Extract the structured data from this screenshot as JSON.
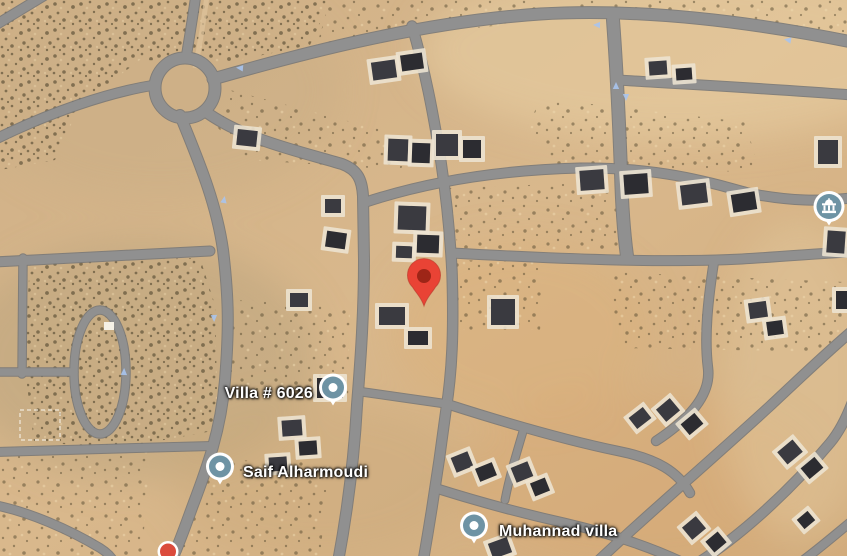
{
  "map": {
    "view_type": "satellite",
    "markers": [
      {
        "id": "destination-pin",
        "kind": "pin",
        "x": 424,
        "y": 313,
        "color": "#E94335",
        "inner_color": "#9E2517"
      },
      {
        "id": "poi-villa-6026",
        "kind": "poi",
        "x": 333,
        "y": 393,
        "color": "#6E93A4",
        "label": "Villa # 6026",
        "label_x": 313,
        "label_y": 394,
        "label_anchor": "end"
      },
      {
        "id": "poi-saif-alharmoudi",
        "kind": "poi",
        "x": 220,
        "y": 472,
        "color": "#6E93A4",
        "label": "Saif Alharmoudi",
        "label_x": 243,
        "label_y": 473,
        "label_anchor": "start"
      },
      {
        "id": "poi-muhannad-villa",
        "kind": "poi",
        "x": 474,
        "y": 531,
        "color": "#6E93A4",
        "label": "Muhannad villa",
        "label_x": 499,
        "label_y": 532,
        "label_anchor": "start"
      },
      {
        "id": "poi-place-of-worship",
        "kind": "poi-icon",
        "x": 829,
        "y": 212,
        "color": "#6E93A4",
        "icon": "building-icon"
      },
      {
        "id": "poi-red-dot",
        "kind": "dot",
        "x": 168,
        "y": 554,
        "color": "#DB4B3C",
        "inner_color": "#DB4B3C"
      }
    ]
  }
}
